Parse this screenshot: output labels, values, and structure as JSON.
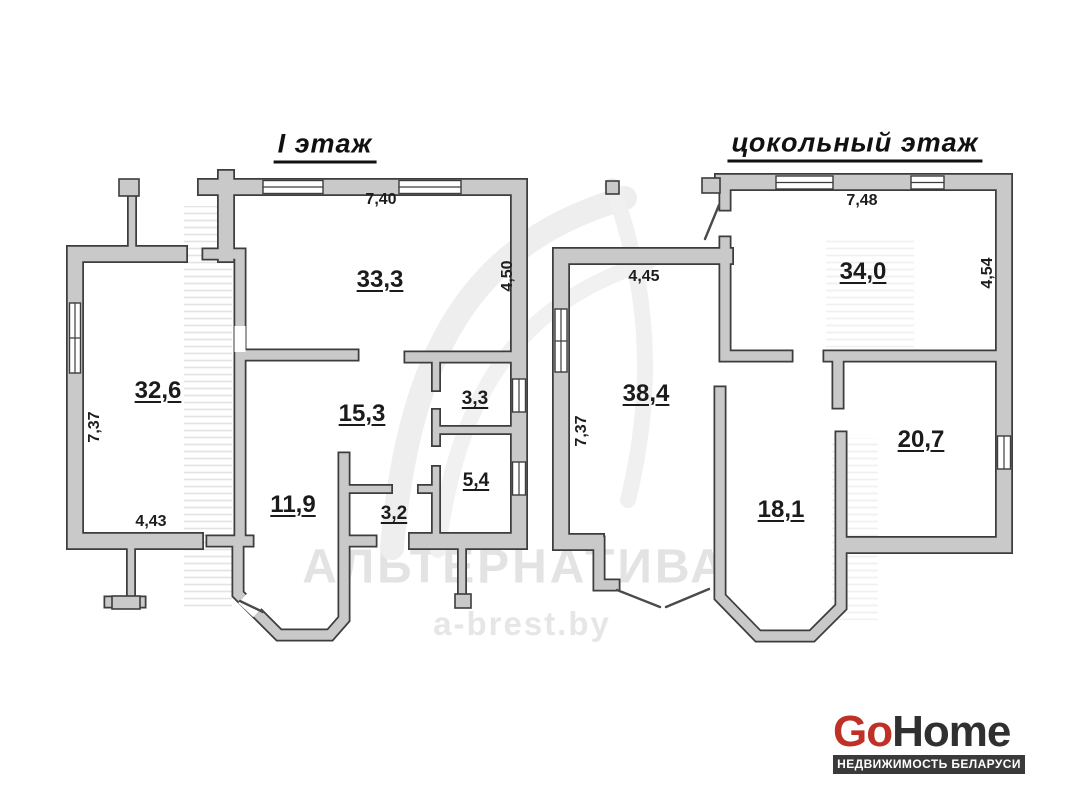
{
  "plans": [
    {
      "title": "I этаж",
      "rooms": [
        "33,3",
        "32,6",
        "15,3",
        "11,9",
        "3,3",
        "5,4",
        "3,2"
      ],
      "dims": [
        "7,40",
        "4,50",
        "7,37",
        "4,43"
      ]
    },
    {
      "title": "цокольный этаж",
      "rooms": [
        "34,0",
        "38,4",
        "18,1",
        "20,7"
      ],
      "dims": [
        "7,48",
        "4,45",
        "4,54",
        "7,37"
      ]
    }
  ],
  "watermark": {
    "brand": "АЛЬТЕРНАТИВА",
    "site": "a-brest.by"
  },
  "logo": {
    "part1": "Go",
    "part2": "Home",
    "tagline": "НЕДВИЖИМОСТЬ БЕЛАРУСИ"
  },
  "colors": {
    "wall_fill": "#c9c9c9",
    "wall_outline": "#3d3d3d",
    "logo_red": "#bf3026",
    "logo_dark": "#303030",
    "tagline_bg": "#3a3a3a",
    "watermark_gray": "#d2d2d2"
  }
}
